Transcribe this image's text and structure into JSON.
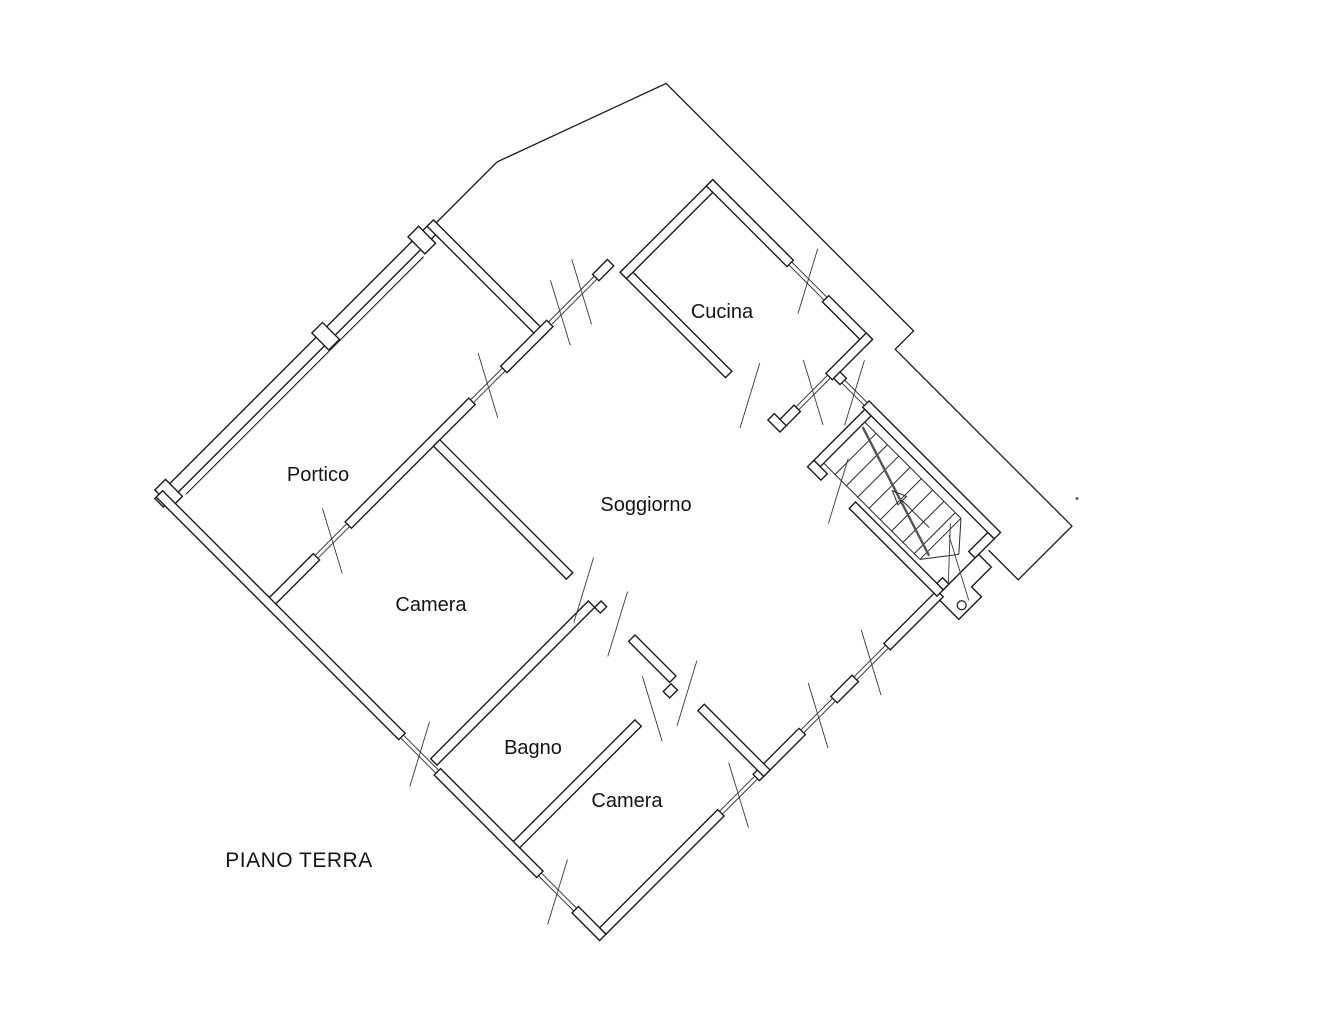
{
  "title": {
    "floor_label": "PIANO TERRA"
  },
  "rooms": {
    "cucina": "Cucina",
    "portico": "Portico",
    "soggiorno": "Soggiorno",
    "camera1": "Camera",
    "bagno": "Bagno",
    "camera2": "Camera"
  },
  "colors": {
    "line": "#1c1c1c",
    "background": "#ffffff"
  },
  "drawing": {
    "type": "floor-plan",
    "rotation_degrees": 45,
    "features": [
      "colonnade-portico",
      "chamfered-corner",
      "terrace-outline",
      "staircase-up-arrow",
      "porch-column",
      "window-double-line-symbols",
      "door-diagonal-tick-symbols"
    ]
  }
}
